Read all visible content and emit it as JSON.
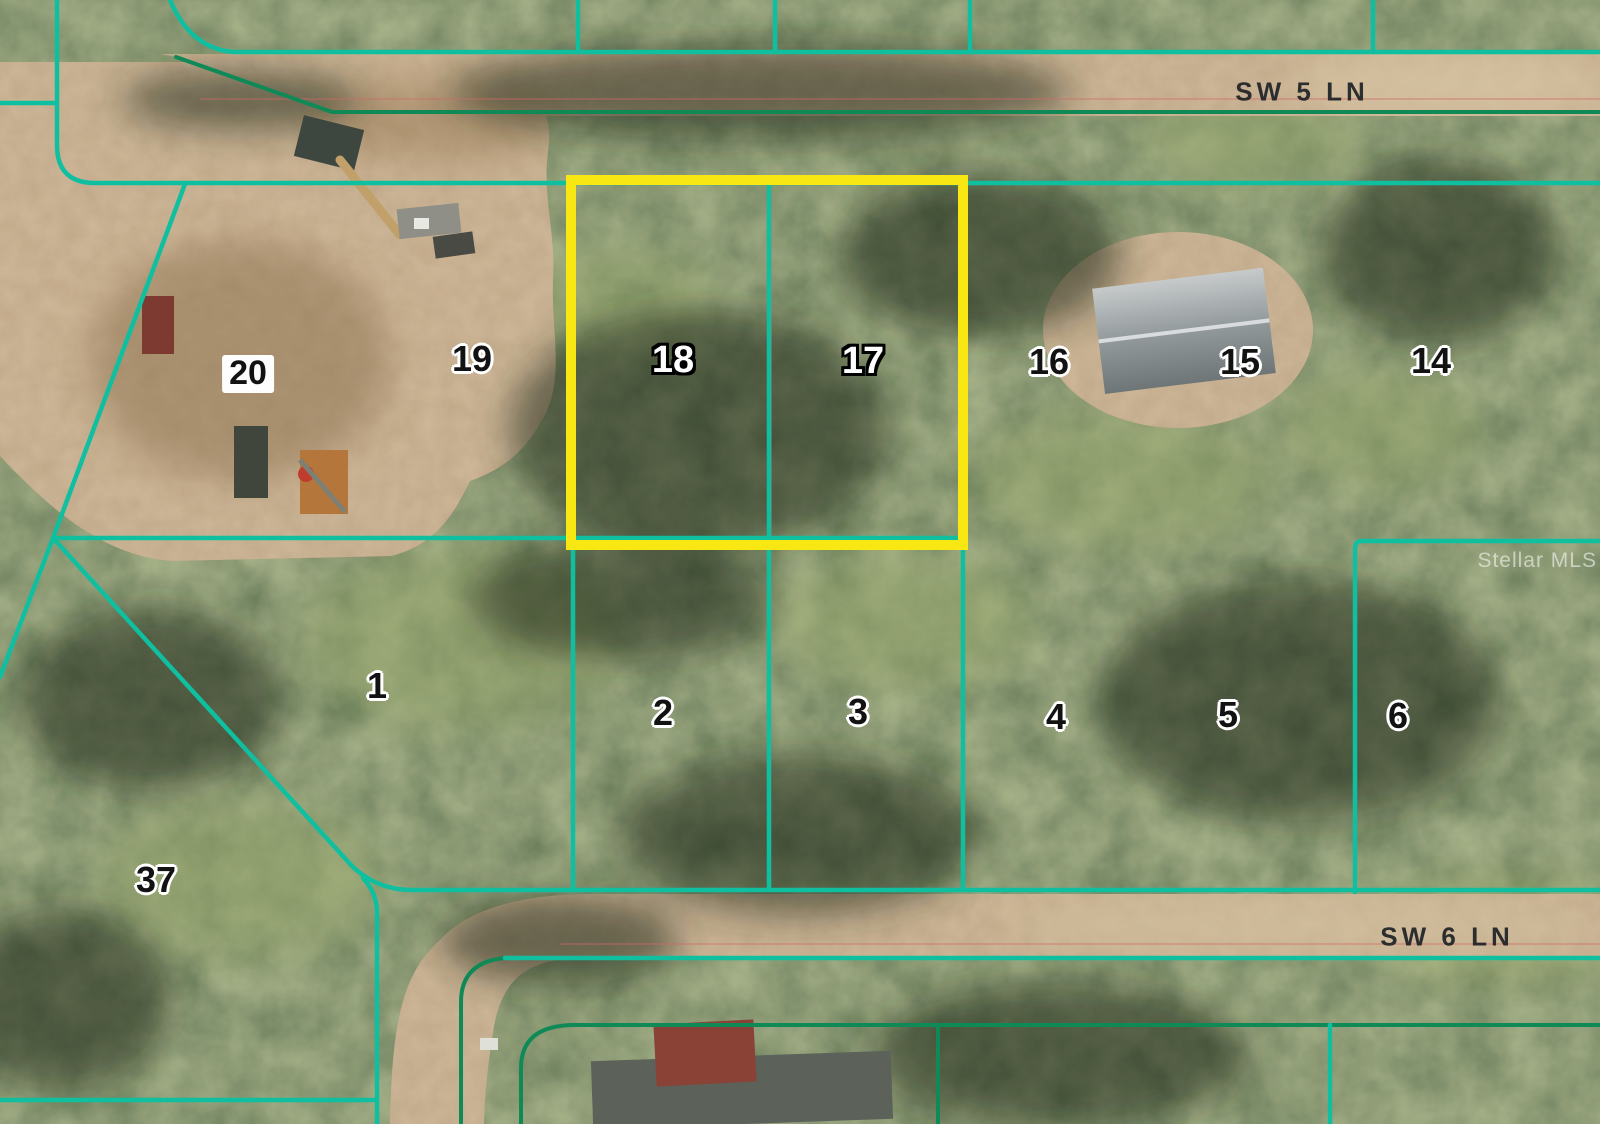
{
  "map": {
    "type": "satellite-parcel-map",
    "streets": {
      "sw5": "SW 5 LN",
      "sw6": "SW 6 LN"
    },
    "watermark": "Stellar MLS",
    "highlight": {
      "lots": "18 & 17",
      "color": "#f8e712"
    },
    "colors": {
      "parcel_line": "#0fbfa0",
      "road_line": "#0f8a57",
      "faint_plat_line": "#d06a6a"
    },
    "lots": [
      {
        "number": "20",
        "style": "chip"
      },
      {
        "number": "19",
        "style": "halo"
      },
      {
        "number": "18",
        "style": "outline"
      },
      {
        "number": "17",
        "style": "outline"
      },
      {
        "number": "16",
        "style": "halo"
      },
      {
        "number": "15",
        "style": "halo"
      },
      {
        "number": "14",
        "style": "halo"
      },
      {
        "number": "1",
        "style": "halo"
      },
      {
        "number": "2",
        "style": "halo"
      },
      {
        "number": "3",
        "style": "halo"
      },
      {
        "number": "4",
        "style": "halo"
      },
      {
        "number": "5",
        "style": "halo"
      },
      {
        "number": "6",
        "style": "halo"
      },
      {
        "number": "37",
        "style": "halo"
      }
    ]
  }
}
